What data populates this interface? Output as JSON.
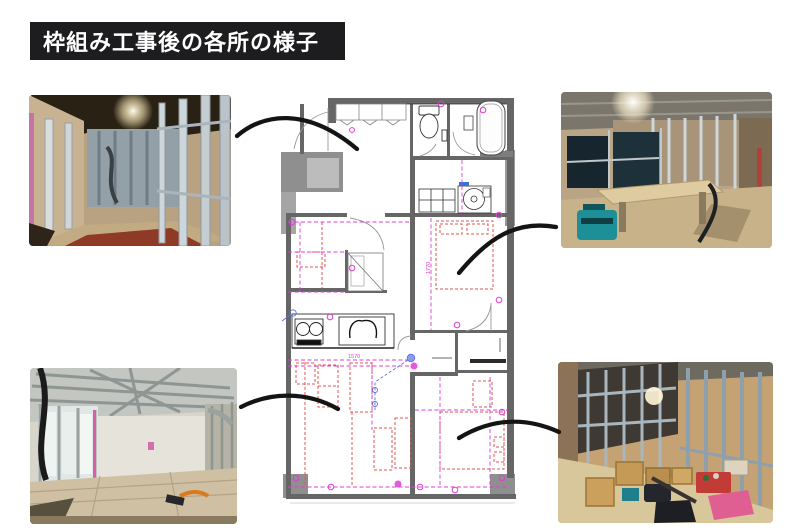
{
  "title": {
    "text": "枠組み工事後の各所の様子"
  },
  "floor_plan": {
    "dimension_labels": [
      {
        "text": "1570"
      },
      {
        "text": "1770"
      }
    ]
  },
  "colors": {
    "banner_black": "#1d1d1f",
    "wall_gray": "#6b6b6b",
    "electrical_magenta": "#e03cd5",
    "furniture_red": "#e2574d",
    "leader_blue": "#5b6fe0",
    "arrow_black": "#141414"
  }
}
